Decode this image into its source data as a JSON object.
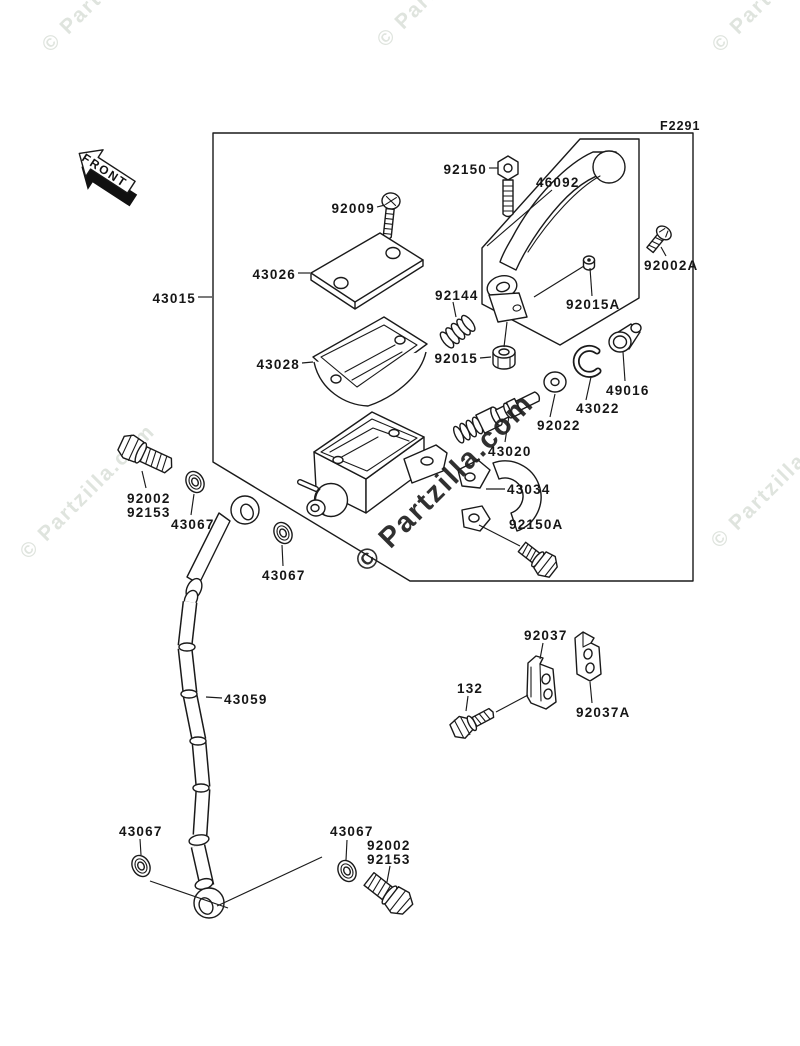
{
  "figure_code": "F2291",
  "front_arrow": {
    "label": "FRONT"
  },
  "watermark_text": "© Partzilla.com",
  "part_labels": [
    {
      "number": "92150"
    },
    {
      "number": "46092"
    },
    {
      "number": "92009"
    },
    {
      "number": "43026"
    },
    {
      "number": "92002A"
    },
    {
      "number": "43015"
    },
    {
      "number": "92144"
    },
    {
      "number": "92015A"
    },
    {
      "number": "43028"
    },
    {
      "number": "92015"
    },
    {
      "number": "49016"
    },
    {
      "number": "43022"
    },
    {
      "number": "92022"
    },
    {
      "number": "43020"
    },
    {
      "number": "43034"
    },
    {
      "number": "92150A"
    },
    {
      "number": "92002"
    },
    {
      "number": "92153"
    },
    {
      "number": "43067"
    },
    {
      "number": "43067"
    },
    {
      "number": "92037"
    },
    {
      "number": "132"
    },
    {
      "number": "92037A"
    },
    {
      "number": "43059"
    },
    {
      "number": "43067"
    },
    {
      "number": "43067"
    },
    {
      "number": "92002"
    },
    {
      "number": "92153"
    }
  ]
}
